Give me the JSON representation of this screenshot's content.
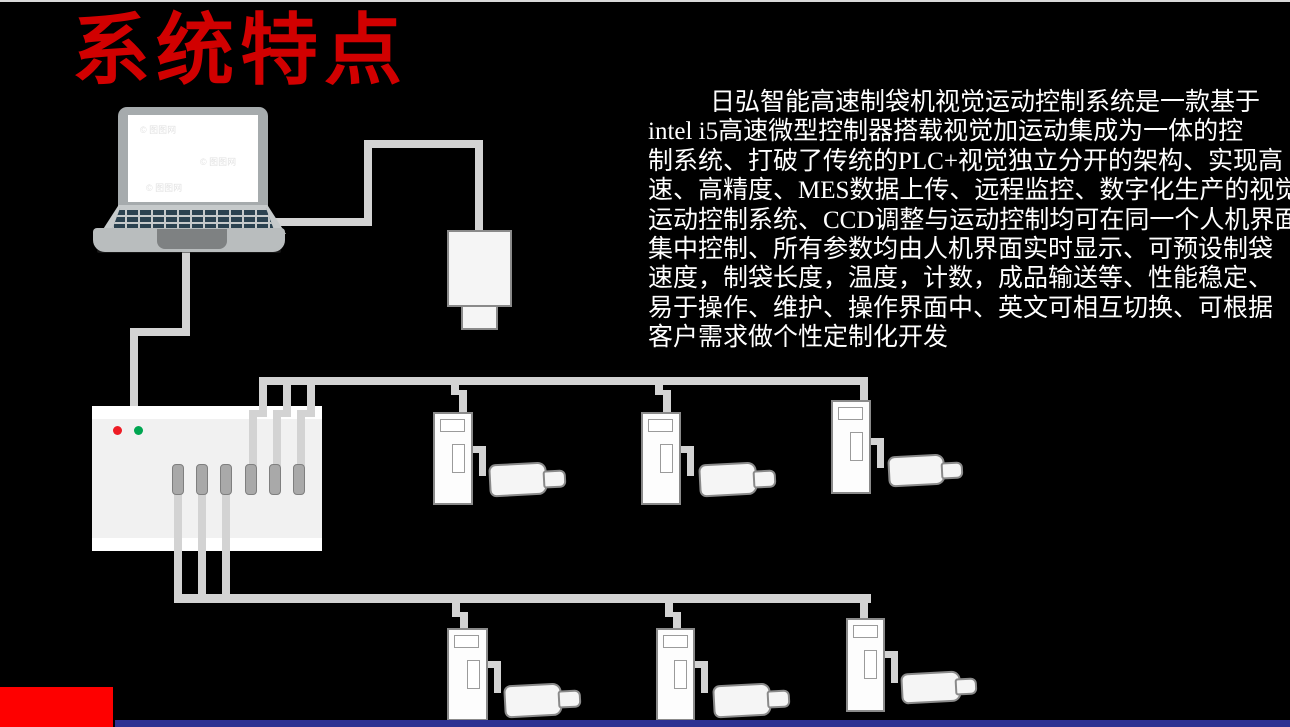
{
  "slide": {
    "title": "系统特点"
  },
  "paragraph": {
    "lines": [
      "日弘智能高速制袋机视觉运动控制系统是一款基于",
      "intel i5高速微型控制器搭载视觉加运动集成为一体的控",
      "制系统、打破了传统的PLC+视觉独立分开的架构、实现高",
      "速、高精度、MES数据上传、远程监控、数字化生产的视觉",
      "运动控制系统、CCD调整与运动控制均可在同一个人机界面",
      "集中控制、所有参数均由人机界面实时显示、可预设制袋",
      "速度，制袋长度，温度，计数，成品输送等、性能稳定、",
      "易于操作、维护、操作界面中、英文可相互切换、可根据",
      "客户需求做个性定制化开发"
    ]
  },
  "laptop_screen": {
    "watermark": "© 图图网"
  },
  "diagram": {
    "nodes": {
      "laptop": "laptop-computer",
      "camera": "ccd-camera",
      "controller": "motion-controller-box",
      "driver": "servo-driver",
      "motor": "servo-motor"
    },
    "controller": {
      "connector_count": 6,
      "leds": [
        "red",
        "green"
      ]
    },
    "motor_units": {
      "top_row_count": 3,
      "bottom_row_count": 3
    }
  },
  "colors": {
    "background": "#000000",
    "title_red": "#d10000",
    "body_text": "#ffffff",
    "cable_gray": "#d3d3d3",
    "device_fill": "#f5f5f5",
    "device_border": "#8a8a8a",
    "controller_fill": "#f1f1f1",
    "controller_bar": "#ffffff",
    "connector_gray": "#a9a9a9",
    "led_red": "#ee1c25",
    "led_green": "#00a651",
    "laptop_body": "#b9bdbe",
    "laptop_lid": "#a6abad",
    "laptop_keys": "#2b4250",
    "screen_white": "#ffffff",
    "accent_red_block": "#fe0000",
    "footer_blue": "#2e3192",
    "top_line": "#d9d9d9"
  }
}
